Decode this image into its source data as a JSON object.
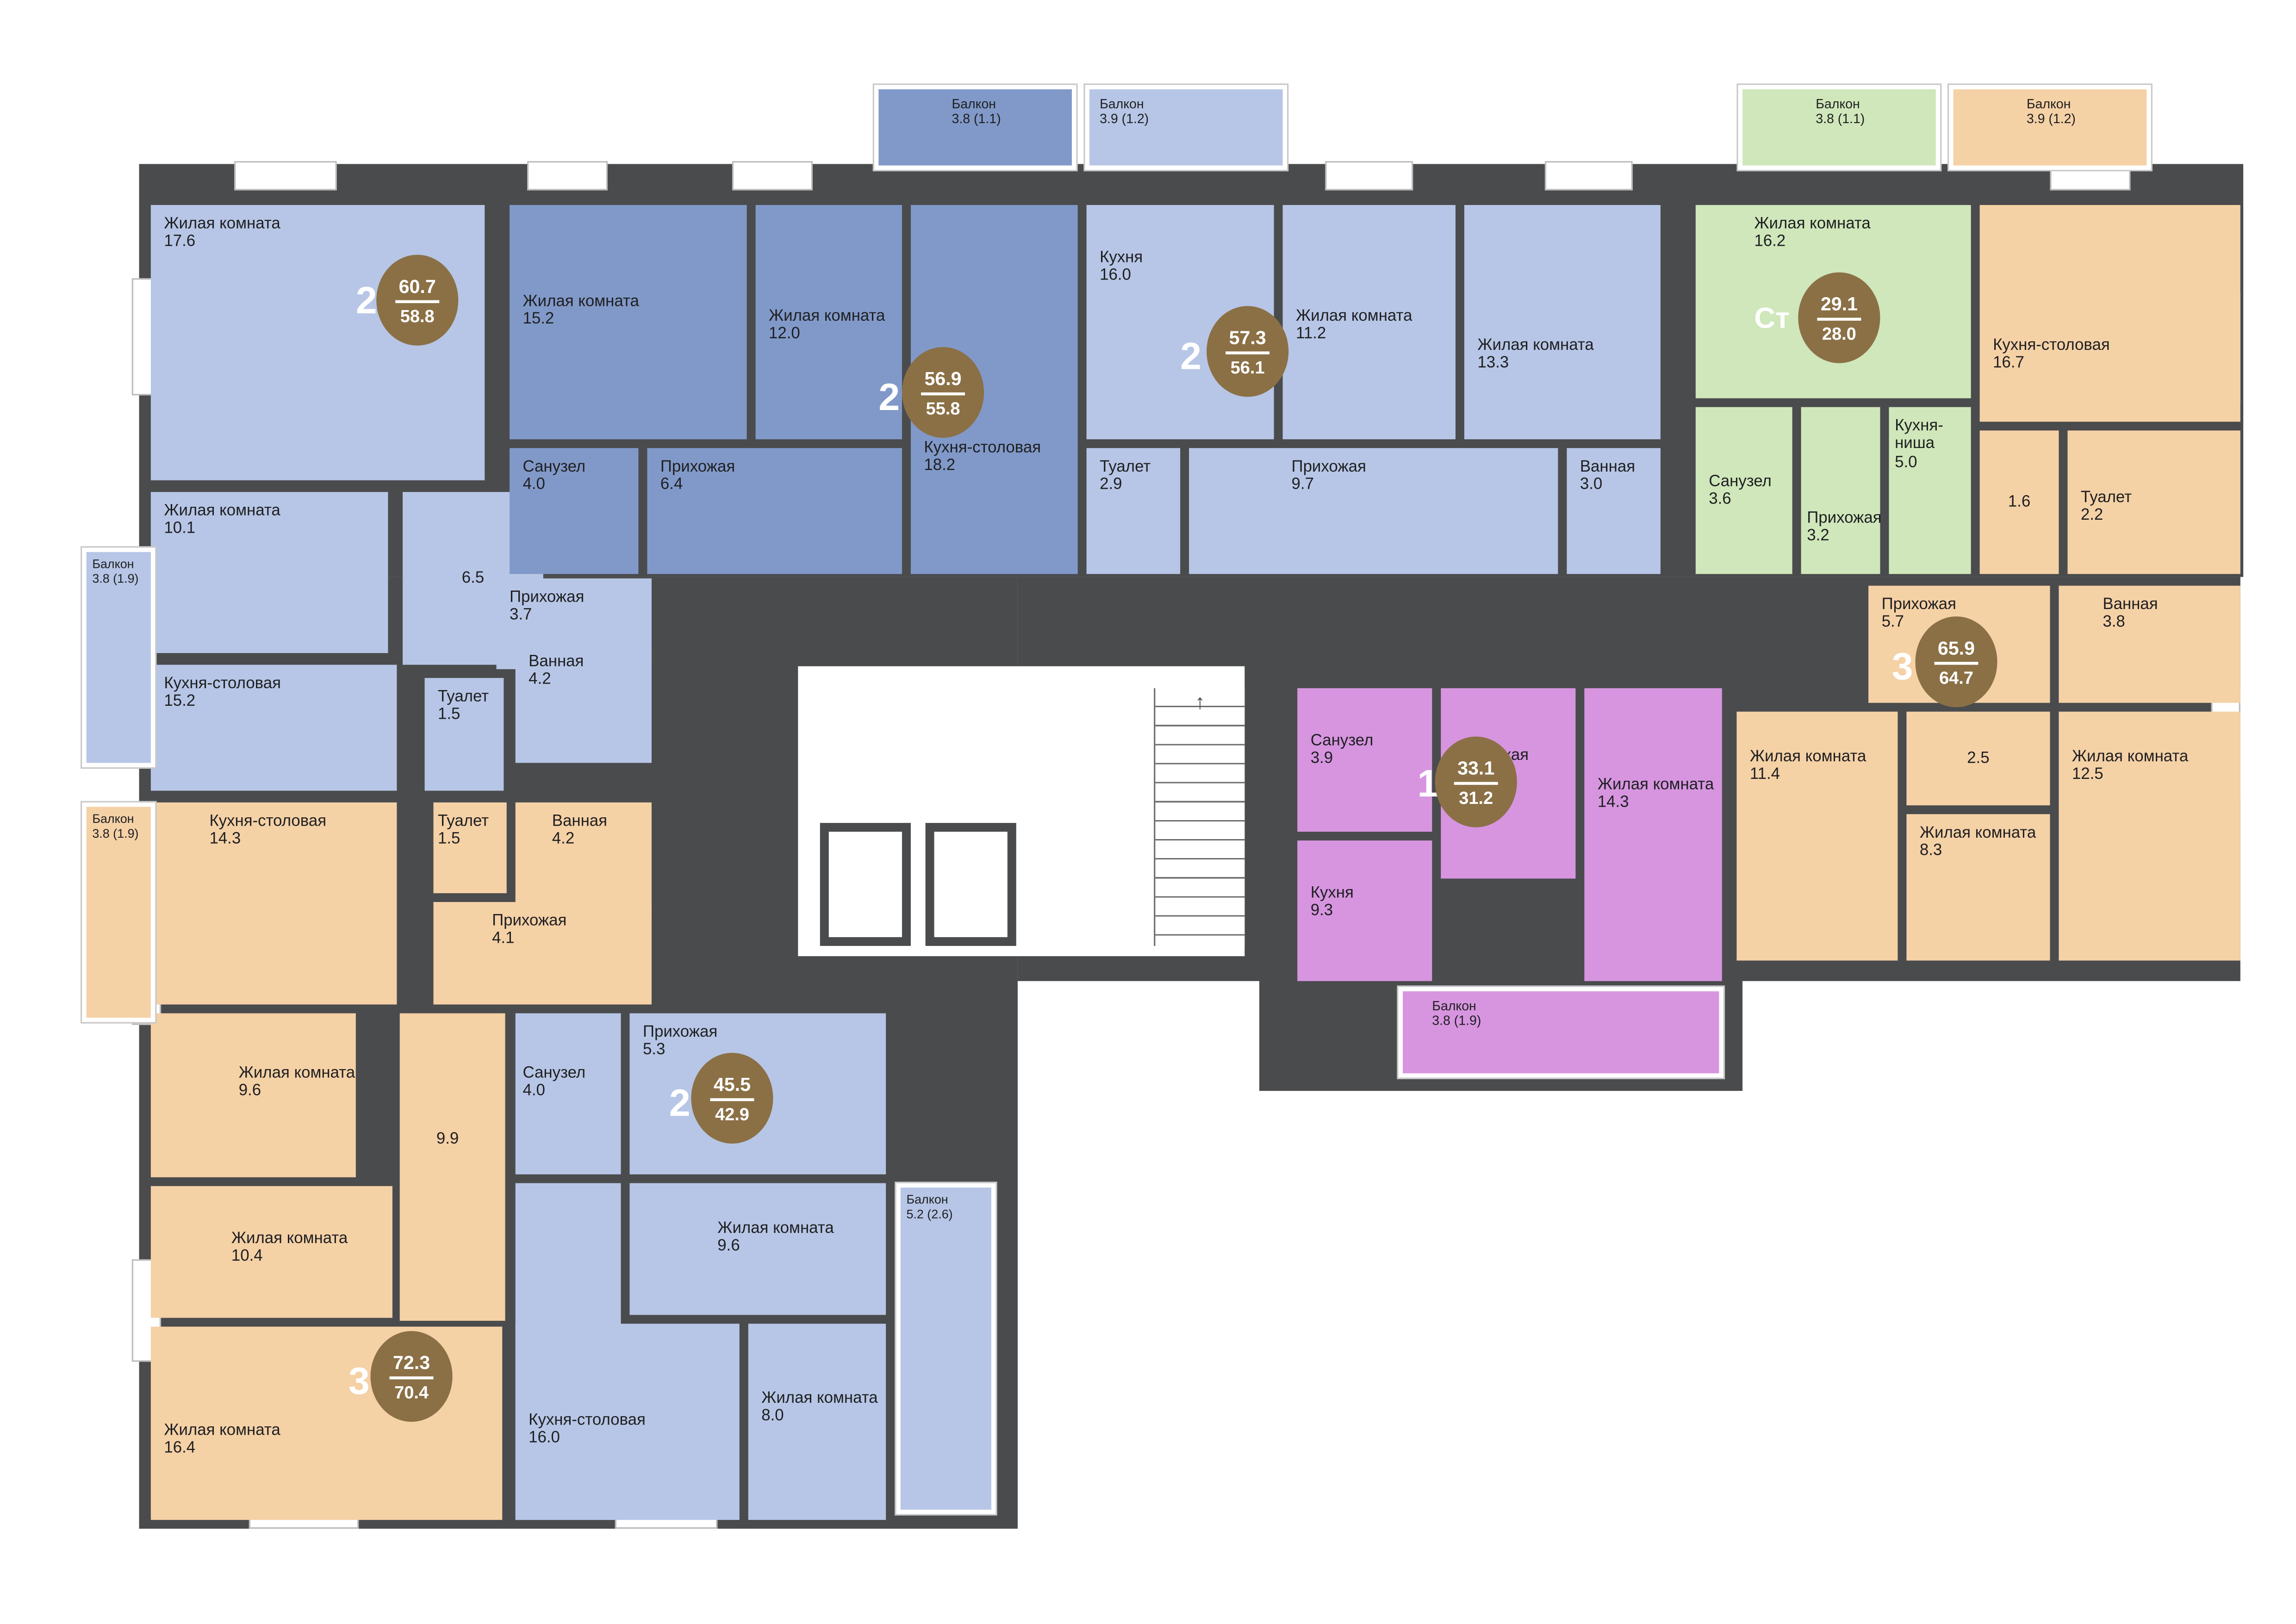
{
  "colors": {
    "wall": "#4a4b4d",
    "blue_light": "#b7c6e6",
    "blue_dark": "#8199c9",
    "green": "#cfe7ba",
    "orange": "#f5d1a6",
    "purple": "#d795e0",
    "badge": "#8b7046",
    "corridor": "#ffffff"
  },
  "apartments": [
    {
      "rooms_label": "2",
      "area_total": "60.7",
      "area_living": "58.8",
      "color": "blue_light",
      "rooms": [
        {
          "label": "Жилая комната",
          "area": "17.6"
        },
        {
          "label": "Жилая комната",
          "area": "10.1"
        },
        {
          "label": "Кухня-столовая",
          "area": "15.2"
        },
        {
          "label": "",
          "area": "6.5"
        },
        {
          "label": "Прихожая",
          "area": "3.7"
        },
        {
          "label": "Туалет",
          "area": "1.5"
        },
        {
          "label": "Ванная",
          "area": "4.2"
        }
      ],
      "balcony": {
        "label": "Балкон",
        "area": "3.8 (1.9)"
      }
    },
    {
      "rooms_label": "2",
      "area_total": "56.9",
      "area_living": "55.8",
      "color": "blue_dark",
      "rooms": [
        {
          "label": "Жилая комната",
          "area": "15.2"
        },
        {
          "label": "Жилая комната",
          "area": "12.0"
        },
        {
          "label": "Кухня-столовая",
          "area": "18.2"
        },
        {
          "label": "Санузел",
          "area": "4.0"
        },
        {
          "label": "Прихожая",
          "area": "6.4"
        }
      ],
      "balcony": {
        "label": "Балкон",
        "area": "3.8 (1.1)"
      }
    },
    {
      "rooms_label": "2",
      "area_total": "57.3",
      "area_living": "56.1",
      "color": "blue_light",
      "rooms": [
        {
          "label": "Кухня",
          "area": "16.0"
        },
        {
          "label": "Жилая комната",
          "area": "11.2"
        },
        {
          "label": "Жилая комната",
          "area": "13.3"
        },
        {
          "label": "Туалет",
          "area": "2.9"
        },
        {
          "label": "Прихожая",
          "area": "9.7"
        },
        {
          "label": "Ванная",
          "area": "3.0"
        }
      ],
      "balcony": {
        "label": "Балкон",
        "area": "3.9 (1.2)"
      }
    },
    {
      "rooms_label": "Ст",
      "area_total": "29.1",
      "area_living": "28.0",
      "color": "green",
      "rooms": [
        {
          "label": "Жилая комната",
          "area": "16.2"
        },
        {
          "label": "Санузел",
          "area": "3.6"
        },
        {
          "label": "Прихожая",
          "area": "3.2"
        },
        {
          "label": "Кухня-ниша",
          "area": "5.0"
        }
      ],
      "balcony": {
        "label": "Балкон",
        "area": "3.8 (1.1)"
      }
    },
    {
      "rooms_label": "3",
      "area_total": "65.9",
      "area_living": "64.7",
      "color": "orange",
      "rooms": [
        {
          "label": "Кухня-столовая",
          "area": "16.7"
        },
        {
          "label": "",
          "area": "1.6"
        },
        {
          "label": "Туалет",
          "area": "2.2"
        },
        {
          "label": "Прихожая",
          "area": "5.7"
        },
        {
          "label": "Ванная",
          "area": "3.8"
        },
        {
          "label": "Жилая комната",
          "area": "11.4"
        },
        {
          "label": "",
          "area": "2.5"
        },
        {
          "label": "Жилая комната",
          "area": "8.3"
        },
        {
          "label": "Жилая комната",
          "area": "12.5"
        }
      ],
      "balcony": {
        "label": "Балкон",
        "area": "3.9 (1.2)"
      }
    },
    {
      "rooms_label": "1",
      "area_total": "33.1",
      "area_living": "31.2",
      "color": "purple",
      "rooms": [
        {
          "label": "Санузел",
          "area": "3.9"
        },
        {
          "label": "Прихожая",
          "area": "3.7"
        },
        {
          "label": "Кухня",
          "area": "9.3"
        },
        {
          "label": "Жилая комната",
          "area": "14.3"
        }
      ],
      "balcony": {
        "label": "Балкон",
        "area": "3.8 (1.9)"
      }
    },
    {
      "rooms_label": "3",
      "area_total": "72.3",
      "area_living": "70.4",
      "color": "orange",
      "rooms": [
        {
          "label": "Кухня-столовая",
          "area": "14.3"
        },
        {
          "label": "Туалет",
          "area": "1.5"
        },
        {
          "label": "Ванная",
          "area": "4.2"
        },
        {
          "label": "Прихожая",
          "area": "4.1"
        },
        {
          "label": "",
          "area": "9.9"
        },
        {
          "label": "Жилая комната",
          "area": "9.6"
        },
        {
          "label": "Жилая комната",
          "area": "10.4"
        },
        {
          "label": "Жилая комната",
          "area": "16.4"
        }
      ],
      "balcony": {
        "label": "Балкон",
        "area": "3.8 (1.9)"
      }
    },
    {
      "rooms_label": "2",
      "area_total": "45.5",
      "area_living": "42.9",
      "color": "blue_light",
      "rooms": [
        {
          "label": "Санузел",
          "area": "4.0"
        },
        {
          "label": "Прихожая",
          "area": "5.3"
        },
        {
          "label": "Жилая комната",
          "area": "9.6"
        },
        {
          "label": "Кухня-столовая",
          "area": "16.0"
        },
        {
          "label": "Жилая комната",
          "area": "8.0"
        }
      ],
      "balcony": {
        "label": "Балкон",
        "area": "5.2 (2.6)"
      }
    }
  ]
}
